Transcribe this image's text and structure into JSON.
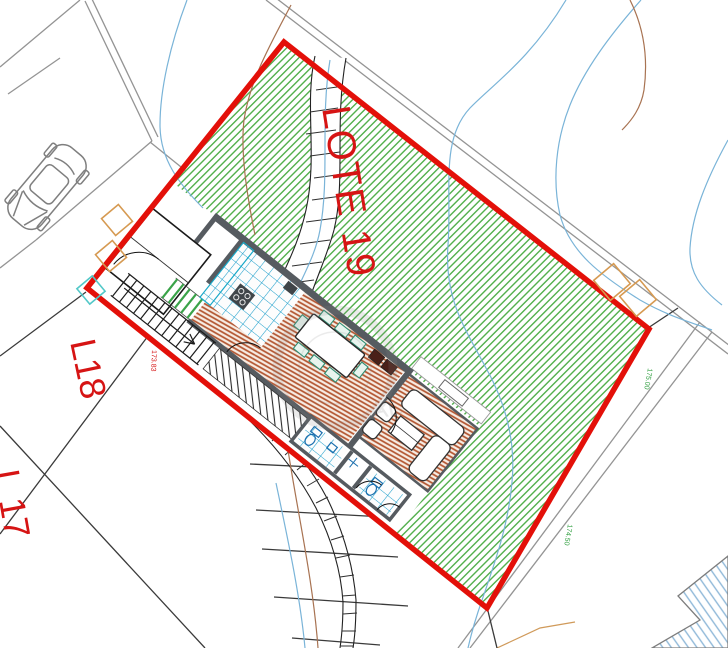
{
  "plan": {
    "lot_label": "LOTE 19",
    "neighbor_left_label": "L18",
    "neighbor_bottom_label": "L 17",
    "elevation_marks": {
      "red_mark": "173.83",
      "green_mark_a": "175.00",
      "green_mark_b": "174.50"
    },
    "watermark_text": "AL",
    "colors": {
      "boundary_red": "#e31009",
      "label_red": "#d61414",
      "lawn_green": "#54b04e",
      "stair_green": "#3aa349",
      "tile_blue": "#1fa0cc",
      "floor_brown": "#b2542f",
      "floor_bg": "#f7ece3",
      "contour_blue": "#7ab4d8",
      "contour_brown": "#a87352",
      "wall_gray": "#565b60",
      "neighbor_line_gray": "#949494",
      "marker_orange": "#d69a52",
      "marker_cyan": "#52c8c8",
      "neighbor_hatch_blue": "#8fb8d8",
      "elevation_green": "#2e9e3e"
    }
  }
}
